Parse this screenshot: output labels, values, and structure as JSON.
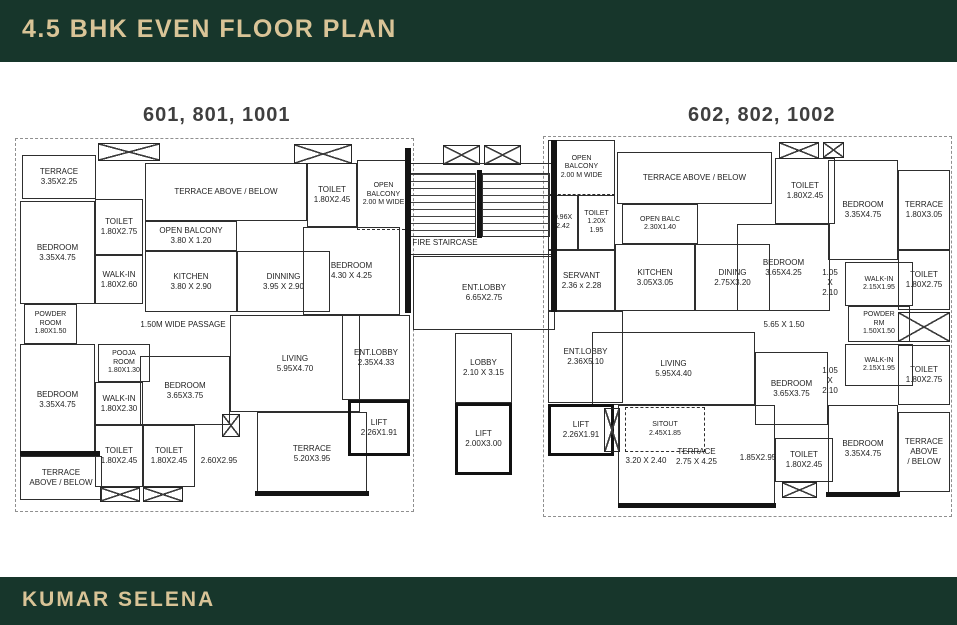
{
  "header": {
    "title": "4.5 BHK EVEN FLOOR PLAN"
  },
  "footer": {
    "brand": "KUMAR SELENA"
  },
  "units": [
    {
      "id": "unit-left",
      "label": "601, 801, 1001"
    },
    {
      "id": "unit-right",
      "label": "602, 802, 1002"
    }
  ],
  "colors": {
    "band_green": "#17362b",
    "cream": "#d9c497",
    "unit_label": "#3f3f3f",
    "line": "#2e2e2e",
    "wall": "#141414"
  },
  "plan": {
    "boundaries": [
      {
        "name": "plot-outline-left",
        "x": 15,
        "y": 138,
        "w": 399,
        "h": 374
      },
      {
        "name": "plot-outline-right",
        "x": 543,
        "y": 136,
        "w": 409,
        "h": 381
      }
    ],
    "rooms": [
      {
        "name": "terrace-top-left",
        "lines": [
          "TERRACE",
          "3.35X2.25"
        ],
        "x": 22,
        "y": 155,
        "w": 74,
        "h": 44
      },
      {
        "name": "toilet-1",
        "lines": [
          "TOILET",
          "1.80X2.75"
        ],
        "x": 95,
        "y": 199,
        "w": 48,
        "h": 56
      },
      {
        "name": "bedroom-1",
        "lines": [
          "BEDROOM",
          "3.35X4.75"
        ],
        "x": 20,
        "y": 201,
        "w": 75,
        "h": 103
      },
      {
        "name": "walkin-1",
        "lines": [
          "WALK-IN",
          "1.80X2.60"
        ],
        "x": 95,
        "y": 255,
        "w": 48,
        "h": 49
      },
      {
        "name": "powder-room-1",
        "cls": "small",
        "lines": [
          "POWDER",
          "ROOM",
          "1.80X1.50"
        ],
        "x": 24,
        "y": 304,
        "w": 53,
        "h": 40
      },
      {
        "name": "terrace-above-below-1",
        "lines": [
          "TERRACE ABOVE / BELOW"
        ],
        "x": 145,
        "y": 163,
        "w": 162,
        "h": 58
      },
      {
        "name": "open-balcony-1",
        "lines": [
          "OPEN BALCONY",
          "3.80 X 1.20"
        ],
        "x": 145,
        "y": 221,
        "w": 92,
        "h": 30
      },
      {
        "name": "kitchen-1",
        "lines": [
          "KITCHEN",
          "3.80 X 2.90"
        ],
        "x": 145,
        "y": 251,
        "w": 92,
        "h": 61
      },
      {
        "name": "dinning-1",
        "lines": [
          "DINNING",
          "3.95 X 2.90"
        ],
        "x": 237,
        "y": 251,
        "w": 93,
        "h": 61
      },
      {
        "name": "toilet-2",
        "lines": [
          "TOILET",
          "1.80X2.45"
        ],
        "x": 307,
        "y": 163,
        "w": 50,
        "h": 64
      },
      {
        "name": "open-balcony-2",
        "cls": "small dashed-b",
        "lines": [
          "OPEN",
          "BALCONY",
          "2.00 M WIDE"
        ],
        "x": 357,
        "y": 160,
        "w": 53,
        "h": 70
      },
      {
        "name": "bedroom-2",
        "lines": [
          "BEDROOM",
          "4.30 X 4.25"
        ],
        "x": 303,
        "y": 227,
        "w": 97,
        "h": 88
      },
      {
        "name": "pooja-room",
        "cls": "small",
        "lines": [
          "POOJA",
          "ROOM",
          "1.80X1.30"
        ],
        "x": 98,
        "y": 344,
        "w": 52,
        "h": 38
      },
      {
        "name": "living-1",
        "lines": [
          "LIVING",
          "5.95X4.70"
        ],
        "x": 230,
        "y": 315,
        "w": 130,
        "h": 97
      },
      {
        "name": "bedroom-3",
        "lines": [
          "BEDROOM",
          "3.65X3.75"
        ],
        "x": 140,
        "y": 356,
        "w": 90,
        "h": 69
      },
      {
        "name": "walkin-2",
        "lines": [
          "WALK-IN",
          "1.80X2.30"
        ],
        "x": 95,
        "y": 382,
        "w": 48,
        "h": 43
      },
      {
        "name": "bedroom-4",
        "lines": [
          "BEDROOM",
          "3.35X4.75"
        ],
        "x": 20,
        "y": 344,
        "w": 75,
        "h": 112
      },
      {
        "name": "toilet-3",
        "lines": [
          "TOILET",
          "1.80X2.45"
        ],
        "x": 95,
        "y": 425,
        "w": 48,
        "h": 62
      },
      {
        "name": "toilet-4",
        "lines": [
          "TOILET",
          "1.80X2.45"
        ],
        "x": 143,
        "y": 425,
        "w": 52,
        "h": 62
      },
      {
        "name": "terrace-2",
        "lines": [
          "TERRACE",
          "5.20X3.95"
        ],
        "x": 257,
        "y": 412,
        "w": 110,
        "h": 83
      },
      {
        "name": "terrace-above-below-2",
        "lines": [
          "TERRACE",
          "ABOVE / BELOW"
        ],
        "x": 20,
        "y": 456,
        "w": 82,
        "h": 44
      },
      {
        "name": "ent-lobby-1",
        "lines": [
          "ENT.LOBBY",
          "2.35X4.33"
        ],
        "x": 342,
        "y": 315,
        "w": 68,
        "h": 85
      },
      {
        "name": "lift-1",
        "cls": "lift",
        "lines": [
          "LIFT",
          "2.26X1.91"
        ],
        "x": 348,
        "y": 400,
        "w": 62,
        "h": 56
      },
      {
        "name": "fire-staircase-room",
        "lines": [],
        "x": 406,
        "y": 163,
        "w": 148,
        "h": 92
      },
      {
        "name": "ent-lobby-center",
        "lines": [
          "ENT.LOBBY",
          "6.65X2.75"
        ],
        "x": 413,
        "y": 256,
        "w": 142,
        "h": 74
      },
      {
        "name": "lobby-center",
        "lines": [
          "LOBBY",
          "2.10 X 3.15"
        ],
        "x": 455,
        "y": 333,
        "w": 57,
        "h": 70
      },
      {
        "name": "lift-center",
        "cls": "lift",
        "lines": [
          "LIFT",
          "2.00X3.00"
        ],
        "x": 455,
        "y": 403,
        "w": 57,
        "h": 72
      },
      {
        "name": "open-balcony-3",
        "cls": "small dashed-b",
        "lines": [
          "OPEN",
          "BALCONY",
          "2.00 M WIDE"
        ],
        "x": 548,
        "y": 140,
        "w": 67,
        "h": 55
      },
      {
        "name": "duct-1",
        "cls": "small",
        "lines": [
          "0.96X",
          "2.42"
        ],
        "x": 548,
        "y": 195,
        "w": 30,
        "h": 55
      },
      {
        "name": "toilet-5",
        "cls": "small",
        "lines": [
          "TOILET",
          "1.20X",
          "1.95"
        ],
        "x": 578,
        "y": 195,
        "w": 37,
        "h": 55
      },
      {
        "name": "terrace-above-below-3",
        "lines": [
          "TERRACE ABOVE / BELOW"
        ],
        "x": 617,
        "y": 152,
        "w": 155,
        "h": 52
      },
      {
        "name": "open-balcony-4",
        "cls": "small",
        "lines": [
          "OPEN BALC",
          "2.30X1.40"
        ],
        "x": 622,
        "y": 204,
        "w": 76,
        "h": 40
      },
      {
        "name": "kitchen-2",
        "lines": [
          "KITCHEN",
          "3.05X3.05"
        ],
        "x": 615,
        "y": 244,
        "w": 80,
        "h": 67
      },
      {
        "name": "dining-2",
        "lines": [
          "DINING",
          "2.75X3.20"
        ],
        "x": 695,
        "y": 244,
        "w": 75,
        "h": 67
      },
      {
        "name": "servant",
        "lines": [
          "SERVANT",
          "2.36 x 2.28"
        ],
        "x": 548,
        "y": 250,
        "w": 67,
        "h": 61
      },
      {
        "name": "toilet-6",
        "lines": [
          "TOILET",
          "1.80X2.45"
        ],
        "x": 775,
        "y": 158,
        "w": 60,
        "h": 66
      },
      {
        "name": "bedroom-5",
        "lines": [
          "BEDROOM",
          "3.65X4.25"
        ],
        "x": 737,
        "y": 224,
        "w": 93,
        "h": 87
      },
      {
        "name": "bedroom-6",
        "lines": [
          "BEDROOM",
          "3.35X4.75"
        ],
        "x": 828,
        "y": 160,
        "w": 70,
        "h": 100
      },
      {
        "name": "terrace-3",
        "lines": [
          "TERRACE",
          "1.80X3.05"
        ],
        "x": 898,
        "y": 170,
        "w": 52,
        "h": 80
      },
      {
        "name": "toilet-7",
        "lines": [
          "TOILET",
          "1.80X2.75"
        ],
        "x": 898,
        "y": 250,
        "w": 52,
        "h": 60
      },
      {
        "name": "walkin-3",
        "cls": "small",
        "lines": [
          "WALK-IN",
          "2.15X1.95"
        ],
        "x": 845,
        "y": 262,
        "w": 68,
        "h": 44
      },
      {
        "name": "powder-room-2",
        "cls": "small",
        "lines": [
          "POWDER",
          "RM",
          "1.50X1.50"
        ],
        "x": 848,
        "y": 306,
        "w": 62,
        "h": 36
      },
      {
        "name": "walkin-4",
        "cls": "small",
        "lines": [
          "WALK-IN",
          "2.15X1.95"
        ],
        "x": 845,
        "y": 344,
        "w": 68,
        "h": 42
      },
      {
        "name": "toilet-8",
        "lines": [
          "TOILET",
          "1.80X2.75"
        ],
        "x": 898,
        "y": 345,
        "w": 52,
        "h": 60
      },
      {
        "name": "ent-lobby-2",
        "lines": [
          "ENT.LOBBY",
          "2.36X5.10"
        ],
        "x": 548,
        "y": 311,
        "w": 75,
        "h": 92
      },
      {
        "name": "living-2",
        "lines": [
          "LIVING",
          "5.95X4.40"
        ],
        "x": 592,
        "y": 332,
        "w": 163,
        "h": 73
      },
      {
        "name": "bedroom-7",
        "lines": [
          "BEDROOM",
          "3.65X3.75"
        ],
        "x": 755,
        "y": 352,
        "w": 73,
        "h": 73
      },
      {
        "name": "bedroom-8",
        "lines": [
          "BEDROOM",
          "3.35X4.75"
        ],
        "x": 828,
        "y": 405,
        "w": 70,
        "h": 88
      },
      {
        "name": "terrace-above-below-4",
        "lines": [
          "TERRACE",
          "ABOVE",
          "/ BELOW"
        ],
        "x": 898,
        "y": 412,
        "w": 52,
        "h": 80
      },
      {
        "name": "toilet-9",
        "lines": [
          "TOILET",
          "1.80X2.45"
        ],
        "x": 775,
        "y": 438,
        "w": 58,
        "h": 44
      },
      {
        "name": "terrace-4",
        "lines": [
          "TERRACE",
          "2.75 X 4.25"
        ],
        "x": 618,
        "y": 405,
        "w": 157,
        "h": 103
      },
      {
        "name": "sitout",
        "cls": "dashed small",
        "lines": [
          "SITOUT",
          "2.45X1.85"
        ],
        "x": 625,
        "y": 407,
        "w": 80,
        "h": 45
      },
      {
        "name": "lift-2",
        "cls": "lift",
        "lines": [
          "LIFT",
          "2.26X1.91"
        ],
        "x": 548,
        "y": 404,
        "w": 66,
        "h": 52
      }
    ],
    "labels": [
      {
        "name": "passage-label",
        "lines": [
          "1.50M WIDE PASSAGE"
        ],
        "x": 128,
        "y": 318,
        "w": 110,
        "h": 14
      },
      {
        "name": "fire-staircase-label",
        "lines": [
          "FIRE STAIRCASE"
        ],
        "x": 406,
        "y": 236,
        "w": 78,
        "h": 14
      },
      {
        "name": "dim-2-60",
        "lines": [
          "2.60X2.95"
        ],
        "x": 193,
        "y": 454,
        "w": 52,
        "h": 14
      },
      {
        "name": "dim-5-65",
        "lines": [
          "5.65 X 1.50"
        ],
        "x": 756,
        "y": 318,
        "w": 56,
        "h": 14
      },
      {
        "name": "dim-1-05-a",
        "lines": [
          "1.05",
          "X",
          "2.10"
        ],
        "x": 816,
        "y": 262,
        "w": 28,
        "h": 42
      },
      {
        "name": "dim-1-05-b",
        "lines": [
          "1.05",
          "X",
          "2.10"
        ],
        "x": 816,
        "y": 360,
        "w": 28,
        "h": 42
      },
      {
        "name": "dim-3-20",
        "lines": [
          "3.20 X 2.40"
        ],
        "x": 618,
        "y": 454,
        "w": 56,
        "h": 14
      },
      {
        "name": "dim-1-85",
        "lines": [
          "1.85X2.95"
        ],
        "x": 736,
        "y": 451,
        "w": 44,
        "h": 14
      }
    ],
    "shafts": [
      {
        "name": "shaft-top-left",
        "x": 98,
        "y": 143,
        "w": 62,
        "h": 18
      },
      {
        "name": "shaft-top-mid-left",
        "x": 294,
        "y": 144,
        "w": 58,
        "h": 20
      },
      {
        "name": "shaft-lift-core-a",
        "x": 443,
        "y": 145,
        "w": 37,
        "h": 20
      },
      {
        "name": "shaft-lift-core-b",
        "x": 484,
        "y": 145,
        "w": 37,
        "h": 20
      },
      {
        "name": "shaft-top-right-a",
        "x": 779,
        "y": 142,
        "w": 40,
        "h": 17
      },
      {
        "name": "shaft-top-right-b",
        "x": 823,
        "y": 142,
        "w": 21,
        "h": 16
      },
      {
        "name": "shaft-bottom-left-a",
        "x": 100,
        "y": 487,
        "w": 40,
        "h": 15
      },
      {
        "name": "shaft-bottom-left-b",
        "x": 143,
        "y": 487,
        "w": 40,
        "h": 15
      },
      {
        "name": "shaft-living-left",
        "x": 222,
        "y": 414,
        "w": 18,
        "h": 23
      },
      {
        "name": "shaft-sitout",
        "x": 604,
        "y": 408,
        "w": 16,
        "h": 44
      },
      {
        "name": "shaft-toilet-right",
        "x": 782,
        "y": 482,
        "w": 35,
        "h": 16
      },
      {
        "name": "shaft-right-edge",
        "x": 898,
        "y": 312,
        "w": 52,
        "h": 30
      }
    ],
    "stairs": [
      {
        "name": "stair-flight-1",
        "x": 410,
        "y": 173,
        "w": 66,
        "h": 64
      },
      {
        "name": "stair-flight-2",
        "x": 482,
        "y": 173,
        "w": 68,
        "h": 64
      }
    ],
    "walls": [
      {
        "name": "wall-core-left",
        "x": 405,
        "y": 148,
        "w": 6,
        "h": 165
      },
      {
        "name": "wall-core-right",
        "x": 551,
        "y": 140,
        "w": 6,
        "h": 172
      },
      {
        "name": "wall-stair-mid",
        "x": 477,
        "y": 170,
        "w": 5,
        "h": 68
      },
      {
        "name": "wall-terrace-left-bottom",
        "x": 255,
        "y": 491,
        "w": 114,
        "h": 5
      },
      {
        "name": "wall-terrace-right-bottom",
        "x": 618,
        "y": 503,
        "w": 158,
        "h": 5
      },
      {
        "name": "wall-left-terrace-top",
        "x": 20,
        "y": 451,
        "w": 80,
        "h": 5
      },
      {
        "name": "wall-bedroom8-bottom",
        "x": 826,
        "y": 492,
        "w": 74,
        "h": 5
      }
    ]
  }
}
